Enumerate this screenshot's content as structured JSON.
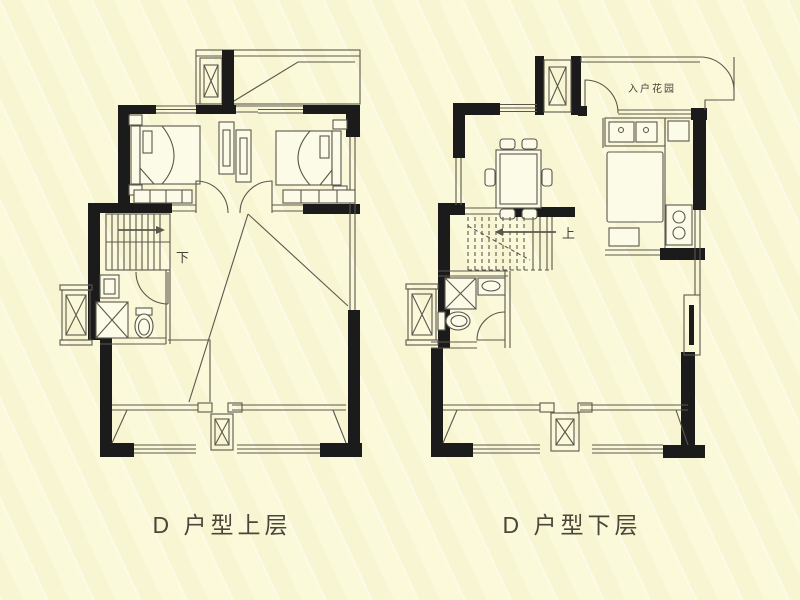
{
  "canvas": {
    "width": 800,
    "height": 600
  },
  "style": {
    "background_color": "#faf8d5",
    "stripe_color": "#fefdf0",
    "wall_color": "#1b1b1b",
    "line_color": "#5c574d",
    "text_color": "#46423a"
  },
  "plans": {
    "upper": {
      "caption": "D 户型上层",
      "stair_label": "下"
    },
    "lower": {
      "caption": "D 户型下层",
      "stair_label": "上",
      "entry_garden_label": "入户花园"
    }
  }
}
